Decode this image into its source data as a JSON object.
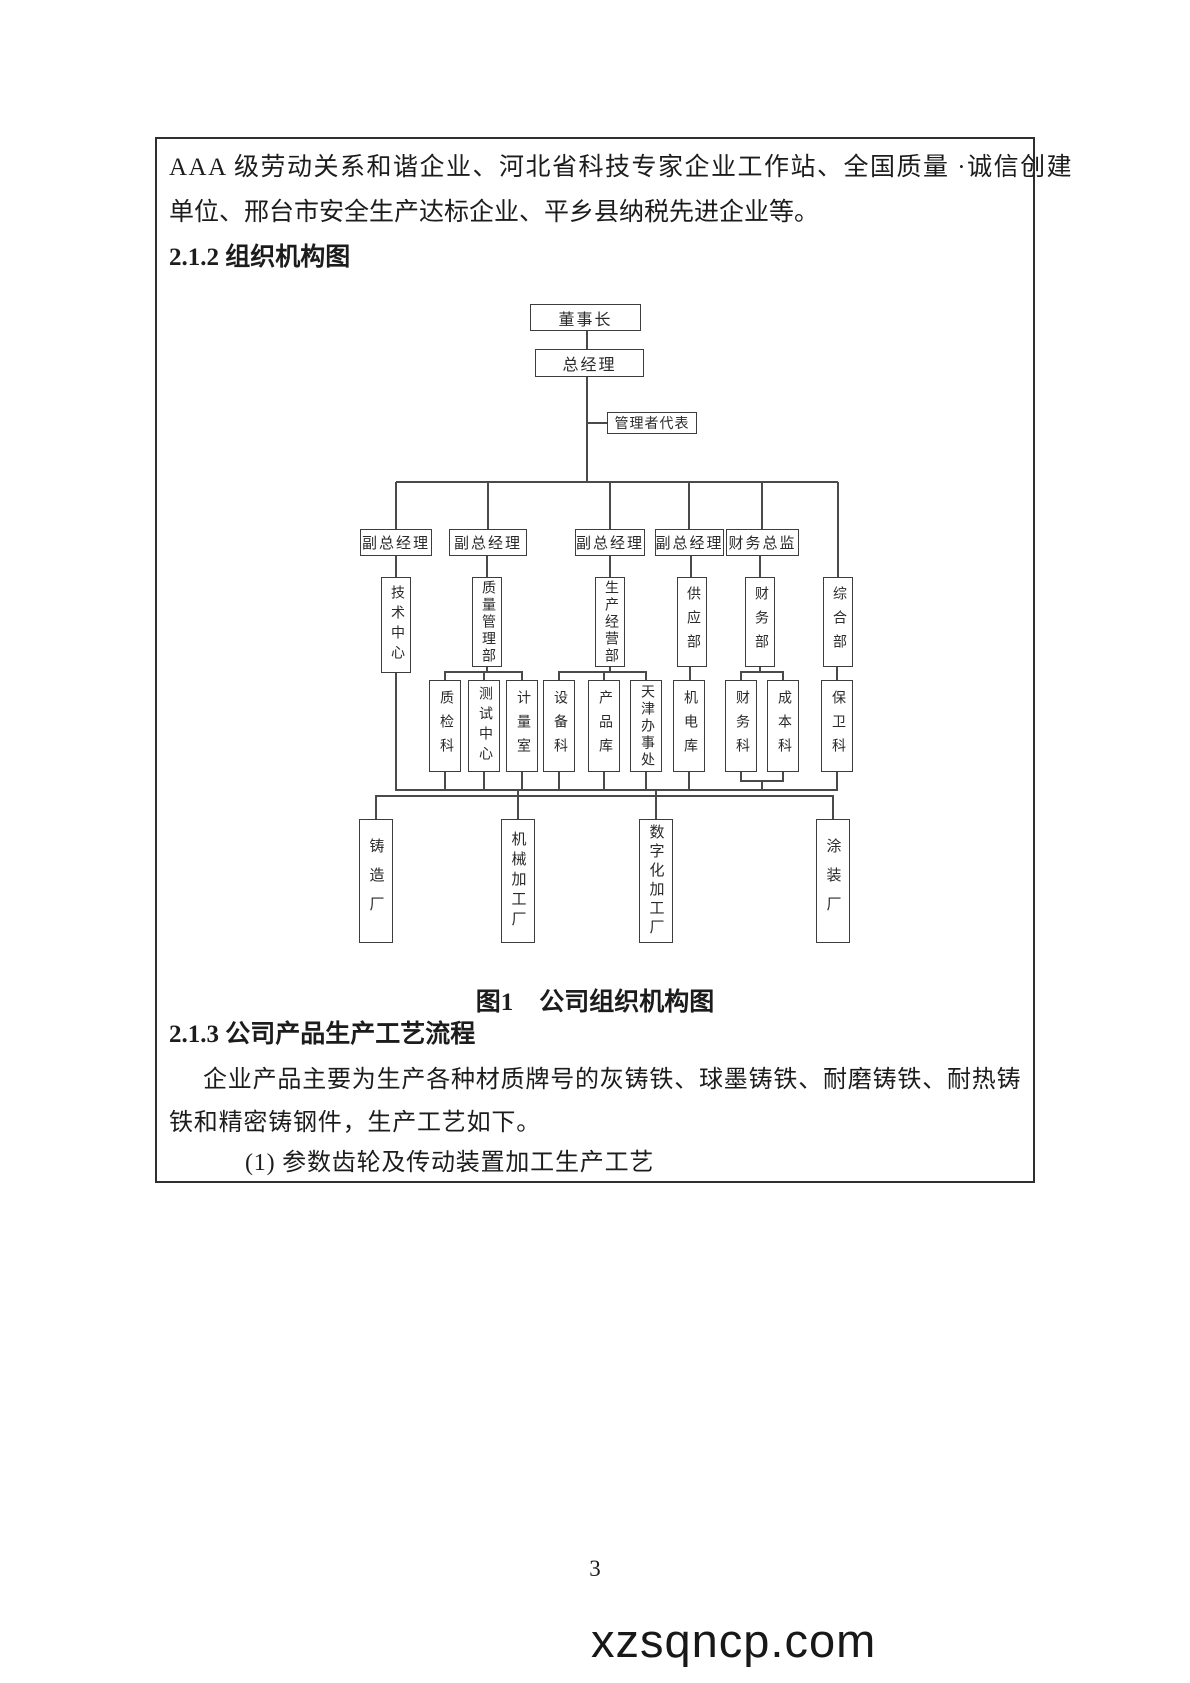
{
  "document": {
    "intro_line1": "AAA 级劳动关系和谐企业、河北省科技专家企业工作站、全国质量 ·诚信创建",
    "intro_line2": "单位、邢台市安全生产达标企业、平乡县纳税先进企业等。",
    "heading_212": "2.1.2 组织机构图",
    "figure": {
      "label": "图1",
      "title": "公司组织机构图"
    },
    "heading_213": "2.1.3 公司产品生产工艺流程",
    "para_line1": "企业产品主要为生产各种材质牌号的灰铸铁、球墨铸铁、耐磨铸铁、耐热铸",
    "para_line2": "铁和精密铸钢件，生产工艺如下。",
    "list_item1": "(1) 参数齿轮及传动装置加工生产工艺",
    "page_number": "3",
    "watermark": "xzsqncp.com"
  },
  "org_chart": {
    "chairman": "董事长",
    "general_manager": "总经理",
    "management_rep": "管理者代表",
    "vp1": "副总经理",
    "vp2": "副总经理",
    "vp3": "副总经理",
    "vp4": "副总经理",
    "cfo": "财务总监",
    "tech_center": "技术中心",
    "quality_dept": "质量管理部",
    "production_dept": "生产经营部",
    "supply_dept": "供应部",
    "finance_dept": "财务部",
    "general_dept": "综合部",
    "qc_section": "质检科",
    "test_center": "测试中心",
    "metrology_room": "计量室",
    "equipment_section": "设备科",
    "product_warehouse": "产品库",
    "tianjin_office": "天津办事处",
    "mech_elec_warehouse": "机电库",
    "finance_section": "财务科",
    "cost_section": "成本科",
    "security_section": "保卫科",
    "foundry": "铸造厂",
    "machining_plant": "机械加工厂",
    "digital_plant": "数字化加工厂",
    "painting_plant": "涂装厂"
  },
  "colors": {
    "ink": "#1c1c1c",
    "line": "#4a4a4a"
  }
}
